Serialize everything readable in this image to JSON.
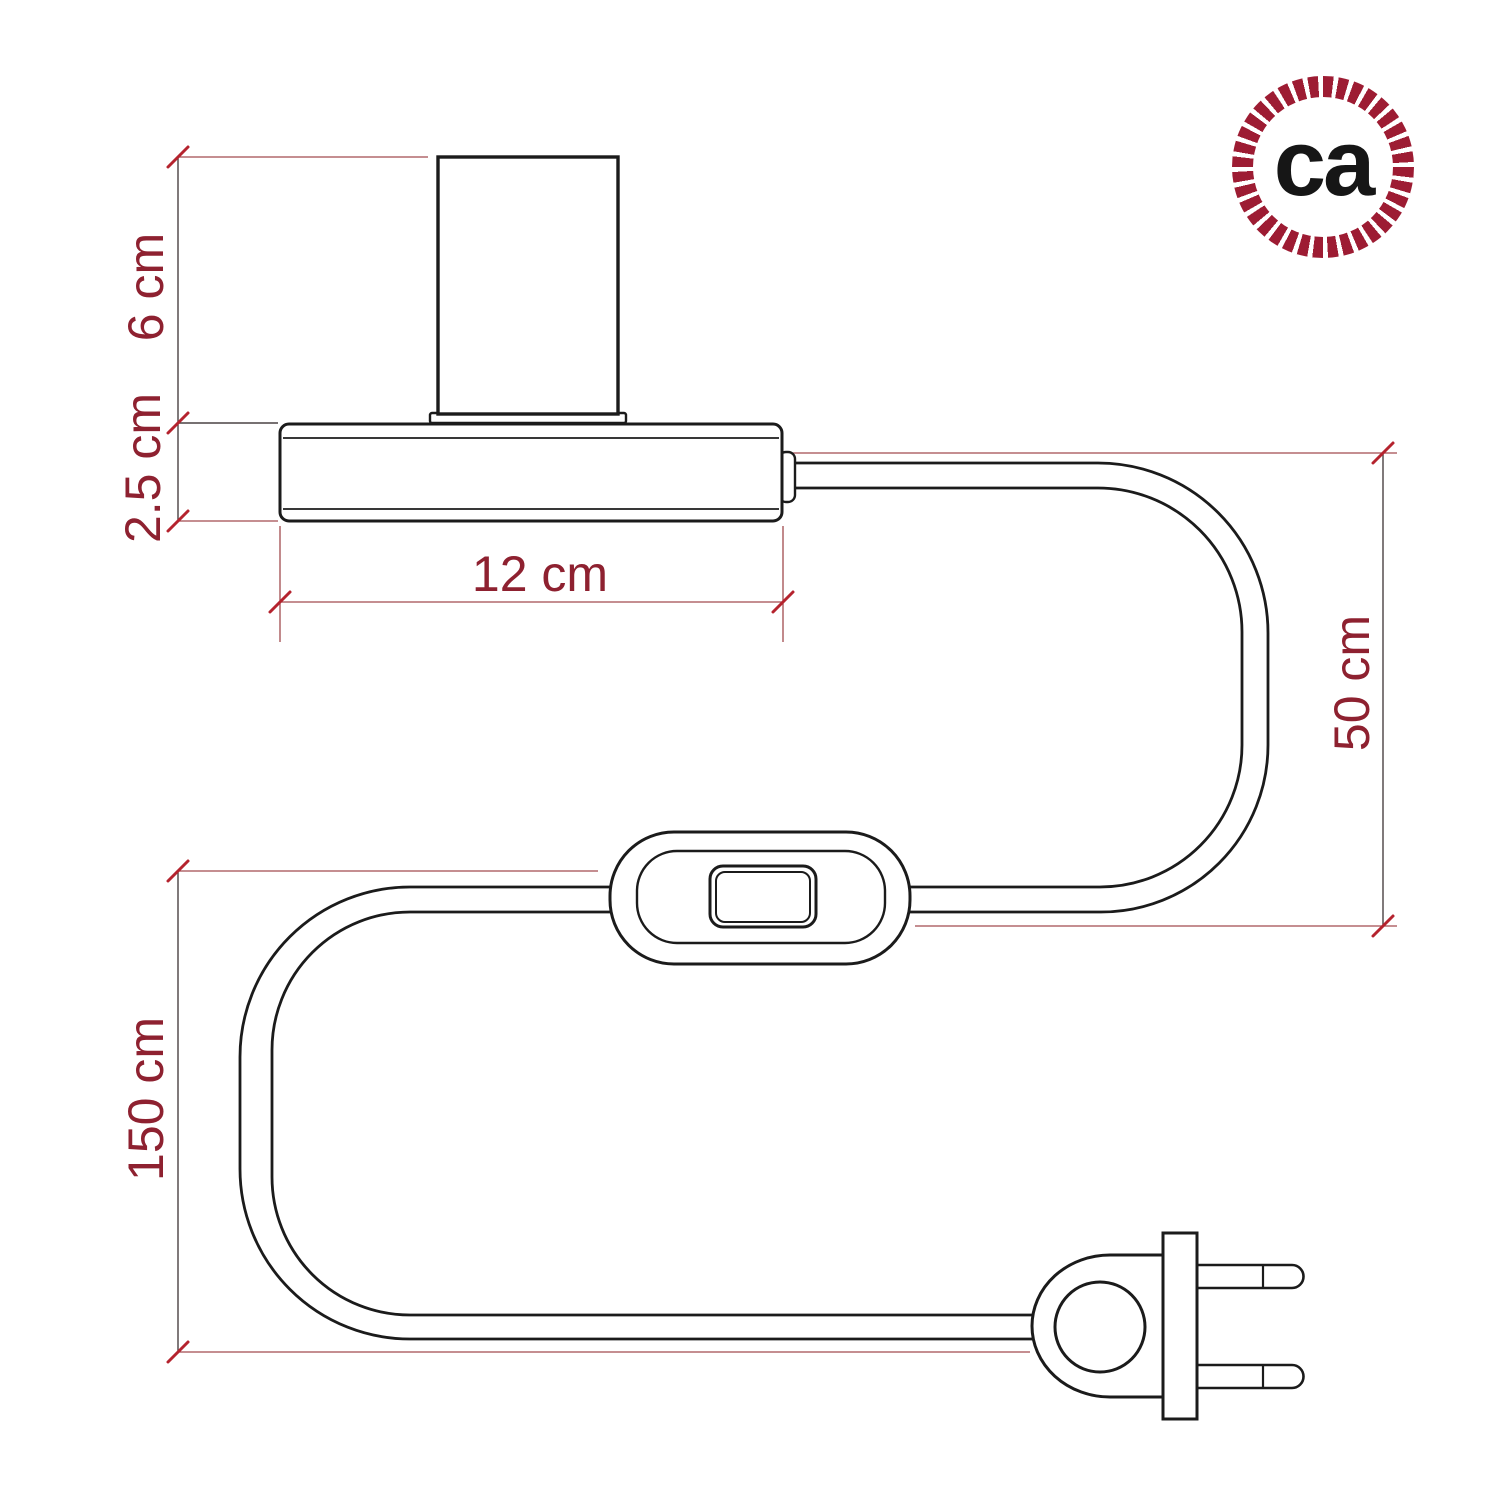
{
  "brand": {
    "logo_text": "ca",
    "ring_color": "#9d1c33"
  },
  "diagram": {
    "type": "product-dimension-drawing",
    "product": "table lamp base with inline switch and two-pin plug",
    "line_color": "#1b1b1b",
    "dimension_line_color": "#a24a4f",
    "tick_color": "#b5232e",
    "text_color": "#8e2130",
    "labels": {
      "socket_height": "6 cm",
      "base_height": "2.5 cm",
      "base_width": "12 cm",
      "cable_base_to_switch": "50 cm",
      "cable_switch_to_plug": "150 cm"
    }
  }
}
